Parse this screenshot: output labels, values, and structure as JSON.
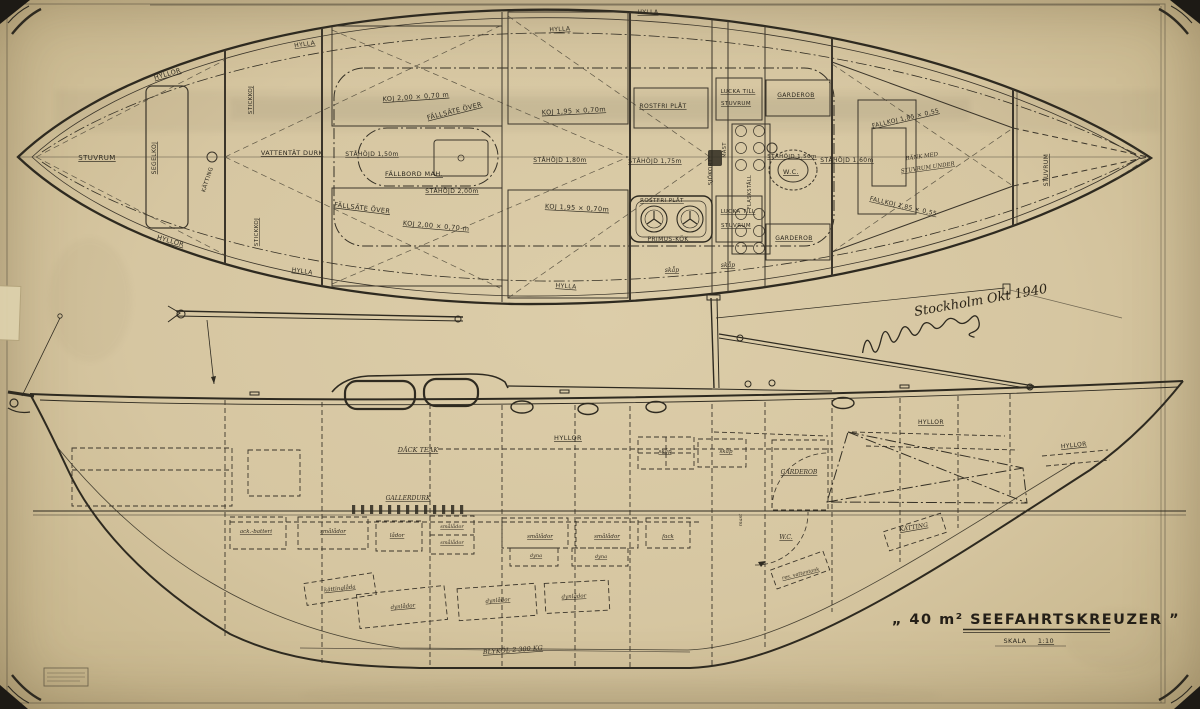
{
  "colors": {
    "paper": "#d8c9a6",
    "ink": "#2e2a20"
  },
  "title_block": {
    "title_display": "„ 40 m²  SEEFAHRTSKREUZER ”",
    "scale_label": "SKALA",
    "scale_value": "1:10"
  },
  "signature": {
    "place_date": "Stockholm  Okt 1940"
  },
  "plan_labels": [
    {
      "t": "STUVRUM",
      "x": 97,
      "y": 160,
      "s": 7,
      "u": 1
    },
    {
      "t": "HYLLOR",
      "x": 168,
      "y": 76,
      "r": -16,
      "s": 6.5,
      "u": 1
    },
    {
      "t": "HYLLOR",
      "x": 170,
      "y": 243,
      "r": 16,
      "s": 6.5,
      "u": 1
    },
    {
      "t": "SEGELKOJ",
      "x": 156,
      "y": 158,
      "r": -90,
      "s": 6,
      "u": 1
    },
    {
      "t": "KÄTTING",
      "x": 209,
      "y": 180,
      "r": -72,
      "s": 5.5
    },
    {
      "t": "STICKKOJ",
      "x": 252,
      "y": 100,
      "r": -90,
      "s": 5.5,
      "u": 1
    },
    {
      "t": "STICKKOJ",
      "x": 258,
      "y": 232,
      "r": -90,
      "s": 5.5,
      "u": 1
    },
    {
      "t": "VATTENTÄT  DURK",
      "x": 292,
      "y": 155,
      "s": 6.5,
      "u": 1
    },
    {
      "t": "HYLLA",
      "x": 305,
      "y": 46,
      "r": -8,
      "s": 6,
      "u": 1
    },
    {
      "t": "HYLLA",
      "x": 302,
      "y": 273,
      "r": 8,
      "s": 6,
      "u": 1
    },
    {
      "t": "KOJ 2,00 × 0,70 m",
      "x": 416,
      "y": 99,
      "r": -4,
      "s": 6.5,
      "u": 1
    },
    {
      "t": "FÄLLSÄTE ÖVER",
      "x": 455,
      "y": 113,
      "r": -14,
      "s": 6.5,
      "u": 1
    },
    {
      "t": "STÅHÖJD 1,50m",
      "x": 372,
      "y": 156,
      "s": 6,
      "u": 1
    },
    {
      "t": "FÄLLBORD MAH.",
      "x": 414,
      "y": 176,
      "s": 6.5,
      "u": 1
    },
    {
      "t": "STÅHÖJD 2,00m",
      "x": 452,
      "y": 193,
      "s": 6,
      "u": 1
    },
    {
      "t": "FÄLLSÄTE ÖVER",
      "x": 362,
      "y": 210,
      "r": 7,
      "s": 6.5,
      "u": 1
    },
    {
      "t": "KOJ 2,00 × 0,70 m",
      "x": 436,
      "y": 228,
      "r": 5,
      "s": 6.5,
      "u": 1
    },
    {
      "t": "HYLLA",
      "x": 560,
      "y": 31,
      "r": -3,
      "s": 6,
      "u": 1
    },
    {
      "t": "KOJ 1,95 × 0,70m",
      "x": 574,
      "y": 113,
      "r": -3,
      "s": 6.5,
      "u": 1
    },
    {
      "t": "STÅHÖJD 1,80m",
      "x": 560,
      "y": 162,
      "s": 6,
      "u": 1
    },
    {
      "t": "KOJ 1,95 × 0,70m",
      "x": 577,
      "y": 210,
      "r": 3,
      "s": 6.5,
      "u": 1
    },
    {
      "t": "HYLLA",
      "x": 566,
      "y": 288,
      "r": 4,
      "s": 6,
      "u": 1
    },
    {
      "t": "HYLLA",
      "x": 648,
      "y": 14,
      "s": 6,
      "u": 1
    },
    {
      "t": "ROSTFRI PLÅT",
      "x": 663,
      "y": 108,
      "s": 6,
      "u": 1
    },
    {
      "t": "STÅHÖJD 1,75m",
      "x": 655,
      "y": 163,
      "s": 6,
      "u": 1
    },
    {
      "t": "ROSTFRI PLÅT",
      "x": 662,
      "y": 202,
      "s": 5.5,
      "u": 1
    },
    {
      "t": "PRIMUS-KÖK",
      "x": 668,
      "y": 241,
      "s": 6,
      "u": 1
    },
    {
      "t": "skåp",
      "x": 672,
      "y": 272,
      "s": 6,
      "c": "lh",
      "u": 1
    },
    {
      "t": "skåp",
      "x": 728,
      "y": 267,
      "s": 6,
      "c": "lh",
      "u": 1
    },
    {
      "t": "SJÖKORT",
      "x": 712,
      "y": 172,
      "r": -90,
      "s": 5.5
    },
    {
      "t": "MAST",
      "x": 726,
      "y": 150,
      "r": -90,
      "s": 5
    },
    {
      "t": "FLASKSTÄLL",
      "x": 751,
      "y": 192,
      "r": -90,
      "s": 5
    },
    {
      "t": "LUCKA TILL",
      "x": 738,
      "y": 93,
      "s": 5.5,
      "u": 1
    },
    {
      "t": "STUVRUM",
      "x": 736,
      "y": 105,
      "s": 5.5,
      "u": 1
    },
    {
      "t": "GARDEROB",
      "x": 796,
      "y": 97,
      "s": 6,
      "u": 1
    },
    {
      "t": "STÅHÖJD 1,50m",
      "x": 792,
      "y": 158,
      "s": 5.5,
      "u": 1
    },
    {
      "t": "W.C.",
      "x": 791,
      "y": 174,
      "s": 6.5,
      "u": 1
    },
    {
      "t": "STÅHÖJD 1,60m",
      "x": 847,
      "y": 162,
      "s": 6,
      "u": 1
    },
    {
      "t": "LUCKA TILL",
      "x": 738,
      "y": 213,
      "s": 5.5,
      "u": 1
    },
    {
      "t": "STUVRUM",
      "x": 736,
      "y": 227,
      "s": 5.5,
      "u": 1
    },
    {
      "t": "GARDEROB",
      "x": 794,
      "y": 240,
      "s": 6,
      "u": 1
    },
    {
      "t": "FALLKOJ 1,85 × 0,55",
      "x": 906,
      "y": 120,
      "r": -13,
      "s": 6,
      "u": 1
    },
    {
      "t": "BÄNK MED",
      "x": 922,
      "y": 158,
      "r": -8,
      "s": 5.5,
      "c": "lh"
    },
    {
      "t": "STUVRUM UNDER",
      "x": 928,
      "y": 169,
      "r": -8,
      "s": 5.5,
      "c": "lh",
      "u": 1
    },
    {
      "t": "FALLKOJ 1,85 × 0,55",
      "x": 903,
      "y": 208,
      "r": 13,
      "s": 6,
      "u": 1
    },
    {
      "t": "STUVRUM",
      "x": 1048,
      "y": 170,
      "r": -90,
      "s": 6,
      "u": 1
    }
  ],
  "profile_labels": [
    {
      "t": "DÄCK TEAK",
      "x": 418,
      "y": 452,
      "s": 6.5,
      "c": "lh",
      "u": 1
    },
    {
      "t": "HYLLOR",
      "x": 568,
      "y": 440,
      "s": 6.5,
      "u": 1
    },
    {
      "t": "GALLERDURK",
      "x": 408,
      "y": 500,
      "s": 6,
      "c": "lh",
      "u": 1
    },
    {
      "t": "ack.-batteri",
      "x": 256,
      "y": 533,
      "s": 5.5,
      "c": "lh",
      "u": 1
    },
    {
      "t": "smålådor",
      "x": 333,
      "y": 533,
      "s": 5.5,
      "c": "lh",
      "u": 1
    },
    {
      "t": "lådor",
      "x": 397,
      "y": 537,
      "s": 5.5,
      "c": "lh",
      "u": 1
    },
    {
      "t": "smålådor",
      "x": 452,
      "y": 528,
      "s": 5,
      "c": "lh",
      "u": 1
    },
    {
      "t": "smålådor",
      "x": 452,
      "y": 544,
      "s": 5,
      "c": "lh",
      "u": 1
    },
    {
      "t": "smålådor",
      "x": 540,
      "y": 538,
      "s": 5.5,
      "c": "lh",
      "u": 1
    },
    {
      "t": "smålådor",
      "x": 607,
      "y": 538,
      "s": 5.5,
      "c": "lh",
      "u": 1
    },
    {
      "t": "fack",
      "x": 668,
      "y": 538,
      "s": 5.5,
      "c": "lh",
      "u": 1
    },
    {
      "t": "dyna",
      "x": 536,
      "y": 557,
      "s": 5,
      "c": "lh",
      "u": 1
    },
    {
      "t": "dyna",
      "x": 601,
      "y": 558,
      "s": 5,
      "c": "lh",
      "u": 1
    },
    {
      "t": "skåp",
      "x": 665,
      "y": 453,
      "s": 5.5,
      "c": "lh",
      "u": 1
    },
    {
      "t": "skåp",
      "x": 726,
      "y": 453,
      "s": 5.5,
      "c": "lh",
      "u": 1
    },
    {
      "t": "mast",
      "x": 742,
      "y": 520,
      "r": -90,
      "s": 5,
      "c": "lh"
    },
    {
      "t": "HYLLOR",
      "x": 931,
      "y": 424,
      "s": 6,
      "u": 1
    },
    {
      "t": "HYLLOR",
      "x": 1074,
      "y": 447,
      "r": -6,
      "s": 6,
      "u": 1
    },
    {
      "t": "GARDEROB",
      "x": 799,
      "y": 474,
      "s": 6,
      "c": "lh",
      "u": 1
    },
    {
      "t": "W.C.",
      "x": 786,
      "y": 539,
      "s": 6,
      "c": "lh",
      "u": 1
    },
    {
      "t": "KÄTTING",
      "x": 914,
      "y": 529,
      "r": -10,
      "s": 6,
      "c": "lh",
      "u": 1
    },
    {
      "t": "res. vattentank",
      "x": 801,
      "y": 575,
      "r": -14,
      "s": 5,
      "c": "lh",
      "u": 1
    },
    {
      "t": "kättinglåda",
      "x": 340,
      "y": 590,
      "r": -6,
      "s": 5.5,
      "c": "lh",
      "u": 1
    },
    {
      "t": "dynlådor",
      "x": 403,
      "y": 608,
      "r": -5,
      "s": 5.5,
      "c": "lh",
      "u": 1
    },
    {
      "t": "dynlådor",
      "x": 498,
      "y": 602,
      "r": -4,
      "s": 5.5,
      "c": "lh",
      "u": 1
    },
    {
      "t": "dynlådor",
      "x": 574,
      "y": 598,
      "r": -3,
      "s": 5.5,
      "c": "lh",
      "u": 1
    },
    {
      "t": "BLYKÖL  2 300 KG",
      "x": 513,
      "y": 652,
      "r": -4,
      "s": 6.5,
      "c": "lh",
      "u": 1
    }
  ]
}
